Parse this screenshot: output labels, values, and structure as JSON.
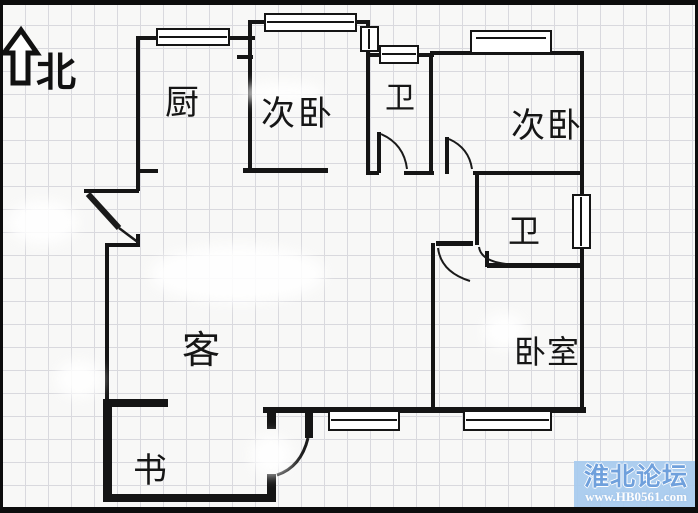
{
  "title": "三室两厅户型图",
  "compass": {
    "label": "北"
  },
  "rooms": [
    {
      "id": "kitchen",
      "label": "厨"
    },
    {
      "id": "second-bedroom-left",
      "label": "次卧"
    },
    {
      "id": "bathroom-top",
      "label": "卫"
    },
    {
      "id": "second-bedroom-right",
      "label": "次卧"
    },
    {
      "id": "bathroom-middle",
      "label": "卫"
    },
    {
      "id": "living-room",
      "label": "客"
    },
    {
      "id": "master-bedroom",
      "label": "卧室"
    },
    {
      "id": "study",
      "label": "书"
    }
  ],
  "watermark": {
    "site_name": "淮北论坛",
    "site_url": "www.HB0561.com",
    "panel_color": "#a7caee",
    "name_color": "#6fa0dc",
    "url_color": "#fdfdfd"
  },
  "colors": {
    "wall": "#151515",
    "grid": "#d9d9de",
    "paper": "#f8f8f7"
  }
}
